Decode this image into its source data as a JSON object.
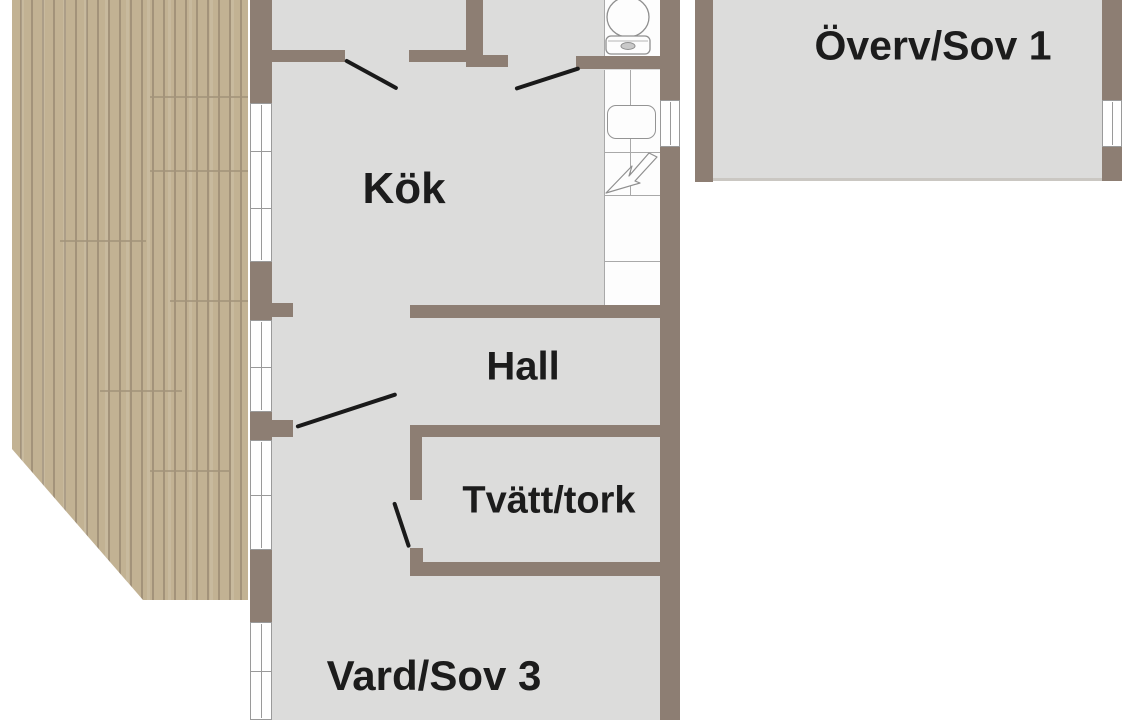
{
  "type": "floor-plan",
  "language": "sv",
  "rooms": [
    {
      "id": "kok",
      "label": "Kök"
    },
    {
      "id": "hall",
      "label": "Hall"
    },
    {
      "id": "tvatt",
      "label": "Tvätt/tork"
    },
    {
      "id": "vard",
      "label": "Vard/Sov 3"
    },
    {
      "id": "overv",
      "label": "Överv/Sov 1"
    }
  ],
  "fixtures": [
    {
      "name": "toilet-icon"
    },
    {
      "name": "sink-icon"
    },
    {
      "name": "lightning-icon"
    }
  ],
  "colors": {
    "background": "#ffffff",
    "wall": "#8d7e73",
    "floor": "#dcdcdb",
    "deck": "#c2b293",
    "deck_stripe": "#a3937a",
    "window_frame": "#9a9a9a",
    "tile_line": "#a9a9a9",
    "door_line": "#1a1a1a",
    "text": "#1c1c1c"
  }
}
